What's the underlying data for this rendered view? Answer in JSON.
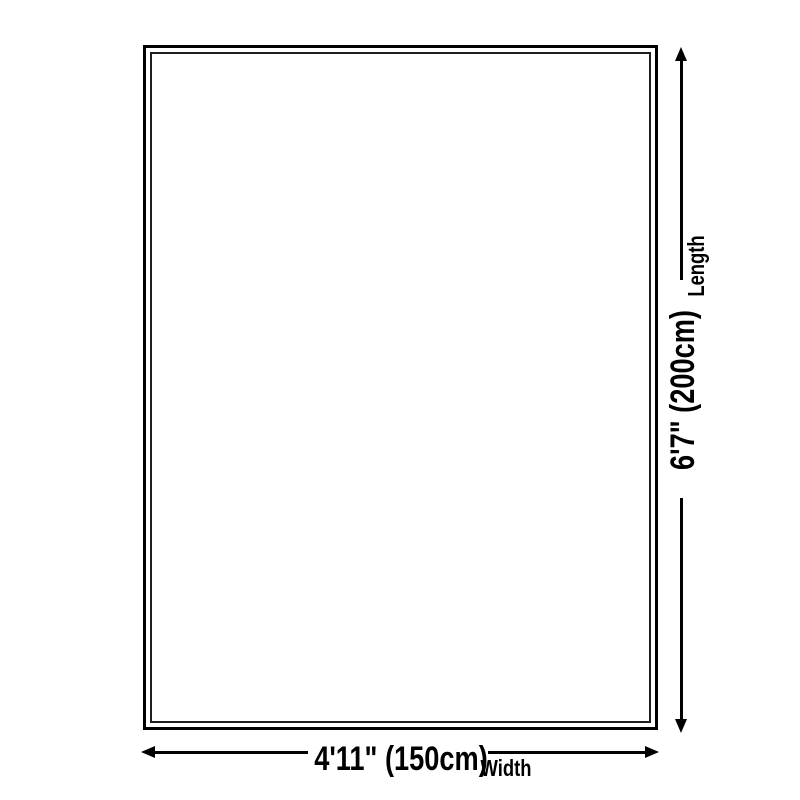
{
  "diagram": {
    "type": "product-dimension-diagram",
    "length": {
      "value": "6'7\" (200cm)",
      "label": "Length"
    },
    "width": {
      "value": "4'11\" (150cm)",
      "label": "Width"
    }
  },
  "colors": {
    "background": "#ffffff",
    "outline": "#000000",
    "inner_outline": "#1f1f1f",
    "arrow": "#000000",
    "text": "#000000"
  }
}
